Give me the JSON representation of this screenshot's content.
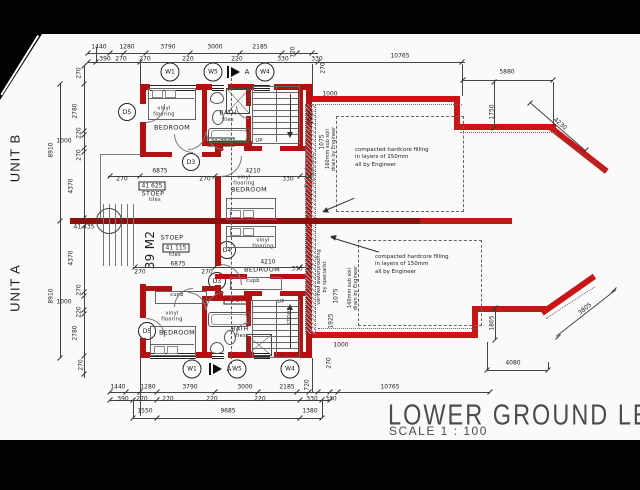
{
  "units": {
    "b": "UNIT B",
    "a": "UNIT A"
  },
  "title": {
    "main": "LOWER GROUND LEVEL",
    "scale": "SCALE 1 : 100"
  },
  "markers": {
    "w1": "W1",
    "w4": "W4",
    "w5": "W5",
    "d3": "D3",
    "d4": "D4",
    "d5": "D5",
    "section": "A"
  },
  "levels": {
    "b_stoep": "41 625",
    "b_landing": "41 750",
    "a_stoep": "41 115",
    "a_landing": "41 200",
    "mid": "41 435"
  },
  "rooms": {
    "bedroom": "BEDROOM",
    "bath": "BATH",
    "tiles": "tiles",
    "stoep": "STOEP",
    "vinyl": "vinyl flooring",
    "cupb": "cupb",
    "up": "UP",
    "store": "STORE",
    "area_a": "39 M2"
  },
  "notes": {
    "hardcore_l1": "compacted hardcore filling",
    "hardcore_l2": "in layers of 150mm",
    "hardcore_l3": "all by Engineer",
    "waterproofing": "verified waterproofing by specialist",
    "drain": "160mm sub soil drain by Engineer"
  },
  "dims": {
    "top_main": [
      "1440",
      "1280",
      "3790",
      "3000",
      "2185",
      "720"
    ],
    "top_sub": [
      "390",
      "270",
      "270",
      "220",
      "220",
      "330",
      "330"
    ],
    "top_right": [
      "10765",
      "270",
      "1000",
      "5880",
      "1750",
      "4230"
    ],
    "right_b": [
      "1925",
      "1075"
    ],
    "right_a": [
      "1075",
      "1925",
      "1000",
      "270"
    ],
    "left_outer": [
      "8910",
      "8910"
    ],
    "left_b": [
      "270",
      "2780",
      "220",
      "1000",
      "270",
      "4370"
    ],
    "left_a": [
      "4370",
      "270",
      "1000",
      "220",
      "2780",
      "270"
    ],
    "mid_b": [
      "6875",
      "270",
      "270",
      "4210",
      "330"
    ],
    "mid_a": [
      "6875",
      "270",
      "270",
      "4210",
      "330"
    ],
    "bottom_main": [
      "1440",
      "1280",
      "3790",
      "3000",
      "2185",
      "720"
    ],
    "bottom_sub": [
      "390",
      "270",
      "270",
      "220",
      "220",
      "330",
      "330"
    ],
    "bottom_row3": [
      "1550",
      "9685",
      "1380"
    ],
    "bottom_right": [
      "10765",
      "4080",
      "1805",
      "3805"
    ]
  }
}
